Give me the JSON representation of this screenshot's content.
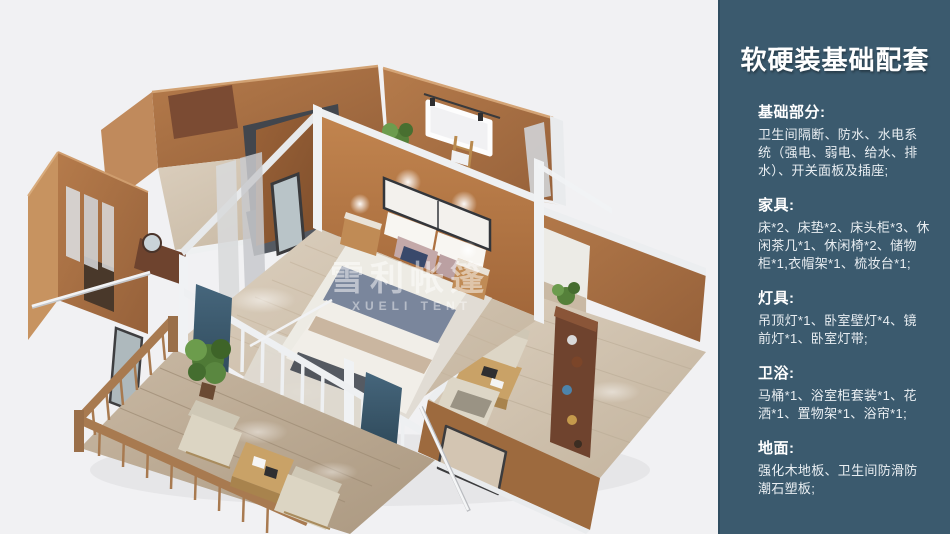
{
  "panel": {
    "title": "软硬装基础配套",
    "sections": [
      {
        "heading": "基础部分:",
        "body": "卫生间隔断、防水、水电系统（强电、弱电、给水、排水）、开关面板及插座;"
      },
      {
        "heading": "家具:",
        "body": "床*2、床垫*2、床头柜*3、休闲茶几*1、休闲椅*2、储物柜*1,衣帽架*1、梳妆台*1;"
      },
      {
        "heading": "灯具:",
        "body": "吊顶灯*1、卧室壁灯*4、镜前灯*1、卧室灯带;"
      },
      {
        "heading": "卫浴:",
        "body": "马桶*1、浴室柜套装*1、花洒*1、置物架*1、浴帘*1;"
      },
      {
        "heading": "地面:",
        "body": "强化木地板、卫生间防滑防潮石塑板;"
      }
    ]
  },
  "illustration": {
    "watermark_main": "雪利帐篷",
    "watermark_sub": "XUELI TENT"
  },
  "colors": {
    "panel_bg": "#3b5a6e",
    "canvas_bg": "#f1f1f3",
    "wall_orange": "#ab7043",
    "floor_wood": "#d6c9b8",
    "bed_blue": "#5d6b85",
    "teal_curtain": "#35586b"
  }
}
